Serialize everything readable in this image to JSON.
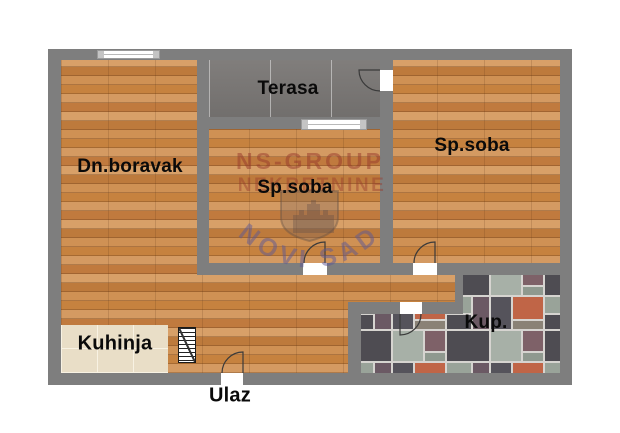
{
  "floorplan": {
    "rooms": [
      {
        "name": "living-room",
        "label": "Dn.boravak"
      },
      {
        "name": "terrace",
        "label": "Terasa"
      },
      {
        "name": "bedroom-middle",
        "label": "Sp.soba"
      },
      {
        "name": "bedroom-right",
        "label": "Sp.soba"
      },
      {
        "name": "kitchen",
        "label": "Kuhinja"
      },
      {
        "name": "bathroom",
        "label": "Kup."
      }
    ],
    "entrance_label": "Ulaz",
    "watermark": {
      "line1": "NS-GROUP",
      "line2": "NEKRETNINE",
      "arc_text": "NOVI SAD"
    },
    "colors": {
      "wall": "#7e7e7e",
      "wood_floor": "#c9894f",
      "terrace_tile": "#7a7775",
      "kitchen_tile": "#e9dec7",
      "bathroom_grout": "#d6d4d0",
      "watermark_red": "#96372a",
      "watermark_blue": "#5c5896"
    }
  }
}
